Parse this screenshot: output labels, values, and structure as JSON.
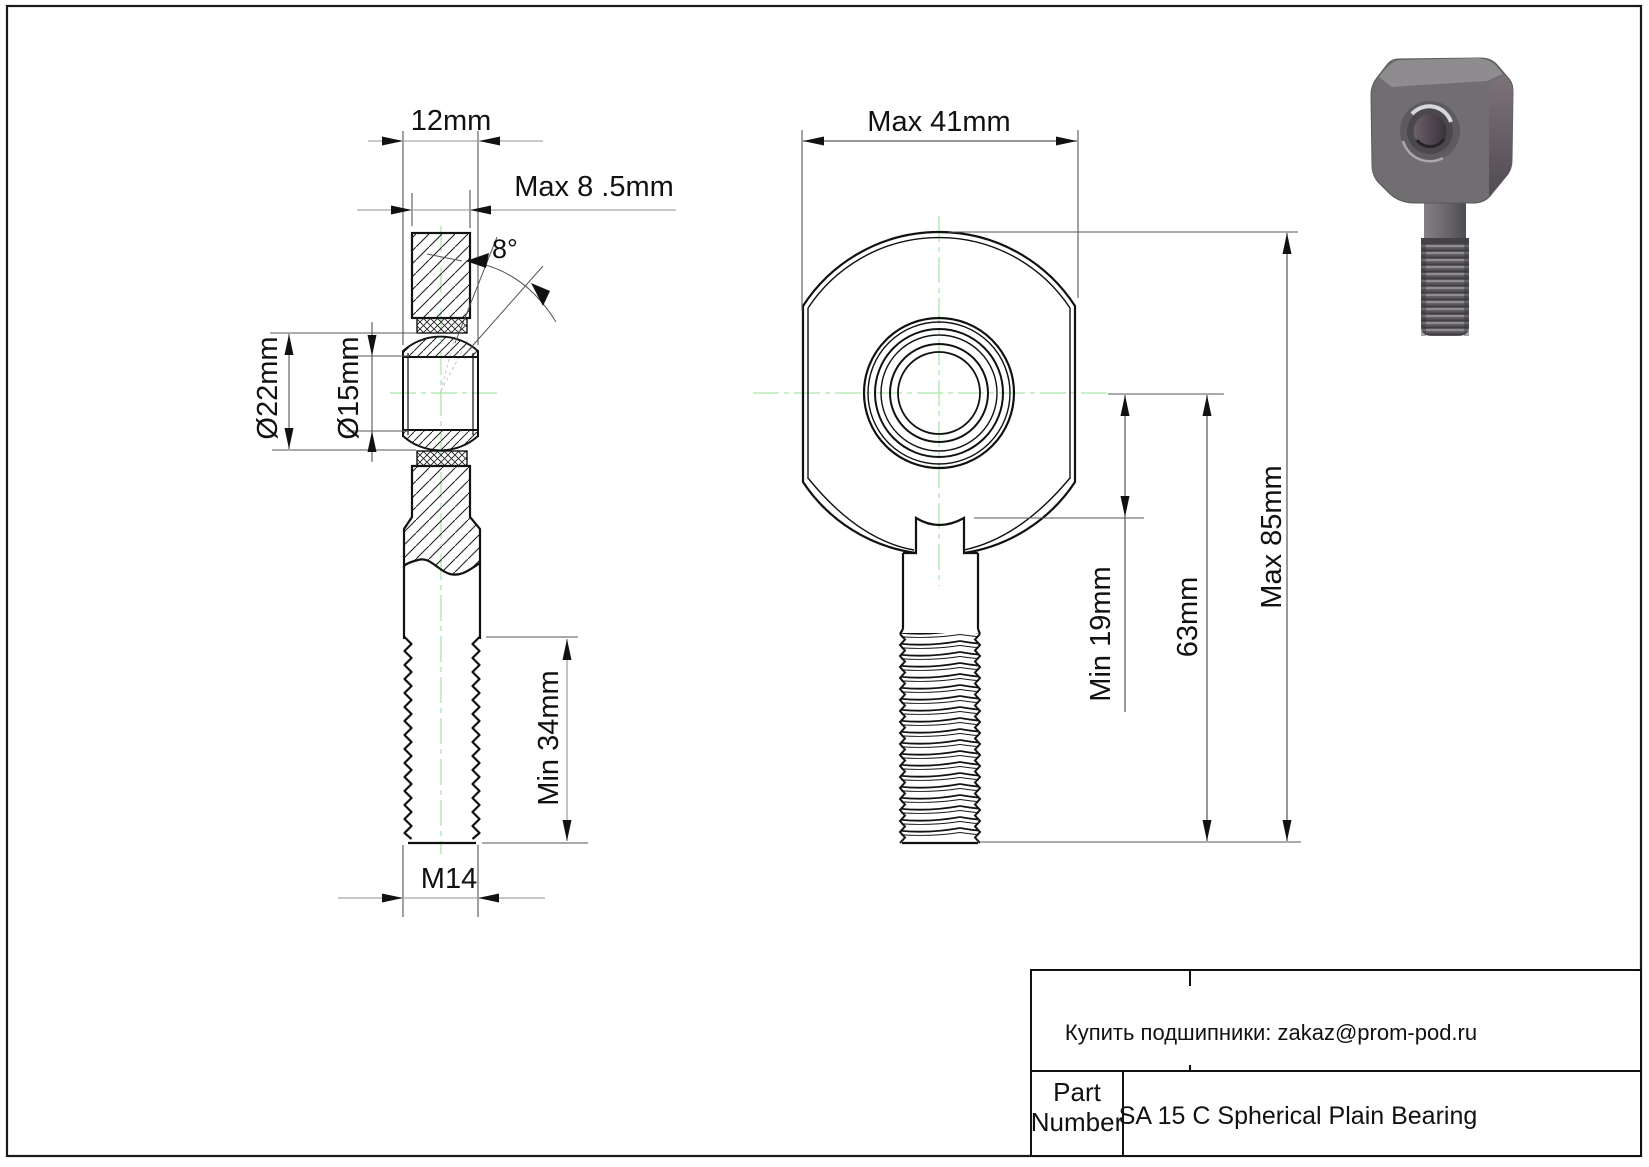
{
  "drawing": {
    "side_view": {
      "dim_ball_width": "12mm",
      "dim_housing_width": "Max 8 .5mm",
      "dim_tilt_angle": "8°",
      "dim_outer_diameter": "Ø22mm",
      "dim_bore_diameter": "Ø15mm",
      "dim_thread_length": "Min 34mm",
      "dim_thread_size": "M14"
    },
    "front_view": {
      "dim_head_width": "Max 41mm",
      "dim_center_to_shoulder": "Min 19mm",
      "dim_center_to_thread_end": "63mm",
      "dim_overall_length": "Max 85mm"
    },
    "title_block": {
      "note": "Купить подшипники: zakaz@prom-pod.ru",
      "part_label_line1": "Part",
      "part_label_line2": "Number",
      "part_name": "SA 15 C Spherical Plain Bearing"
    },
    "colors": {
      "outline": "#111111",
      "centerline_green": "#a9e7a9",
      "dim_gray": "#a6a6a6",
      "render_gray": "#6f6d70"
    }
  }
}
